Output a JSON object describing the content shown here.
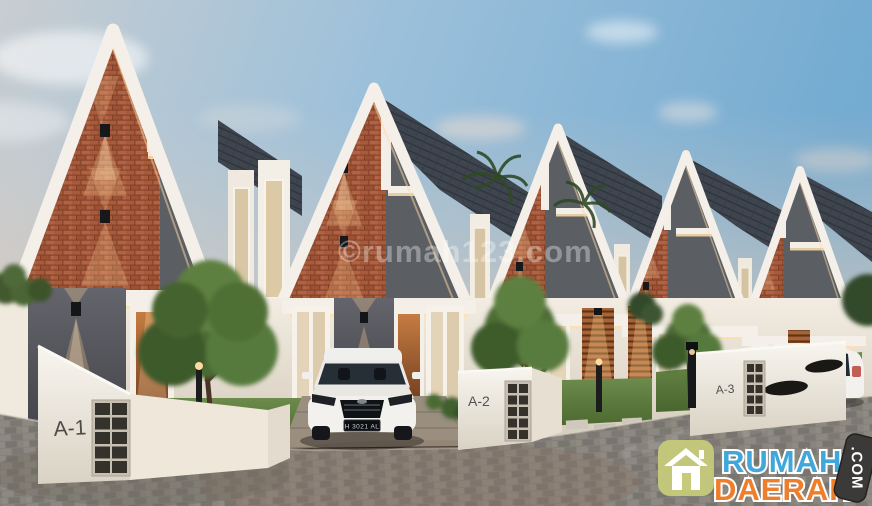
{
  "scene": {
    "type": "architectural-render",
    "description": "Row of five modern two-storey gable townhouses with brick and dark grey facades, white frames, front yards, paved street, a white SUV parked in a driveway and a white MPV at the right",
    "watermark": "©rumah123.com",
    "house_labels": [
      "A-1",
      "A-2",
      "A-3"
    ],
    "license_plate": "H 3021 AL"
  },
  "logo": {
    "word1": "RUMAH",
    "word2": "DAERAH",
    "word3": ".COM",
    "icon": "house-icon"
  },
  "palette": {
    "sky_blue": "#7cb0d3",
    "sky_pale": "#c8cdd1",
    "horizon_warm": "#e8cdb8",
    "brick": "#a65a3c",
    "gable_dark": "#5b5e63",
    "trim_white": "#f3efe8",
    "roof_slate": "#3f454e",
    "grass": "#5e7c41",
    "paving": "#84807a",
    "wood_warm": "#a96334",
    "glow_warm": "#ffd9a6",
    "logo_blue": "#3fa7da",
    "logo_orange": "#ef7e2a",
    "logo_icon_bg": "#c6ca7a",
    "logo_badge_bg": "#3b3a38"
  }
}
